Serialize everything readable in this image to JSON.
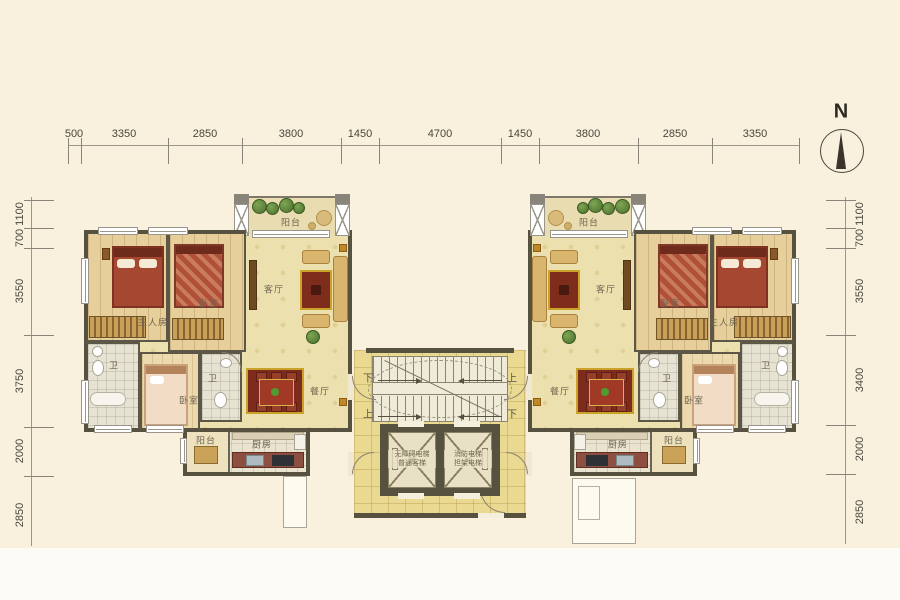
{
  "compass": {
    "label": "N"
  },
  "dims": {
    "top": [
      "500",
      "3350",
      "2850",
      "3800",
      "1450",
      "4700",
      "1450",
      "3800",
      "2850",
      "3350"
    ],
    "left": [
      "1100",
      "700",
      "3550",
      "3750",
      "2000",
      "2850"
    ],
    "right": [
      "1100",
      "700",
      "3550",
      "3400",
      "2000",
      "2850"
    ]
  },
  "core": {
    "stairs": {
      "up": "上",
      "down": "下"
    },
    "elevators": {
      "left": [
        "无障碍电梯",
        "普通客梯"
      ],
      "right": [
        "消防电梯",
        "担架电梯"
      ]
    }
  },
  "rooms": {
    "left": {
      "balcony": "阳台",
      "living": "客厅",
      "master": "主人房",
      "bedroom": "卧室",
      "bath": "卫",
      "bedroom2": "卧室",
      "bath2": "卫",
      "dining": "餐厅",
      "kitchen": "厨房",
      "balcony2": "阳台"
    },
    "right": {
      "balcony": "阳台",
      "living": "客厅",
      "master": "主人房",
      "bedroom": "卧室",
      "bath": "卫",
      "bedroom2": "卧室",
      "bath2": "卫",
      "dining": "餐厅",
      "kitchen": "厨房",
      "balcony2": "阳台"
    }
  },
  "colors": {
    "background": "#f9f1de",
    "wall": "#57523f",
    "wood_floor": "#e7cf9b",
    "pale_floor": "#ece0ae",
    "tile_floor": "#ead990",
    "rug_red": "#7e2c1c",
    "bed_red": "#a64732",
    "plant_green": "#5c7f3c"
  }
}
